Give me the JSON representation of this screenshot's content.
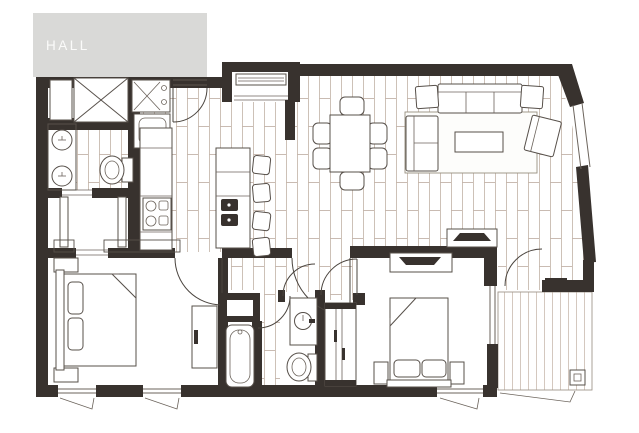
{
  "banner": {
    "label": "HALL"
  },
  "colors": {
    "wall": "#38322e",
    "banner_bg": "#d9d9d7",
    "banner_text": "#fbfbfa",
    "wood_hatch": "#c8baaf",
    "deck_hatch": "#cfc2b8",
    "furniture_line": "#57504a",
    "floor": "#ffffff"
  },
  "fixtures": {
    "plan_type": "apartment-floor-plan",
    "areas": [
      "hall-banner",
      "entry",
      "kitchen",
      "dining-area",
      "living-room",
      "laundry-wc",
      "closet",
      "vestibule",
      "bedroom-1",
      "bathroom",
      "wc",
      "bedroom-2",
      "balcony"
    ]
  }
}
